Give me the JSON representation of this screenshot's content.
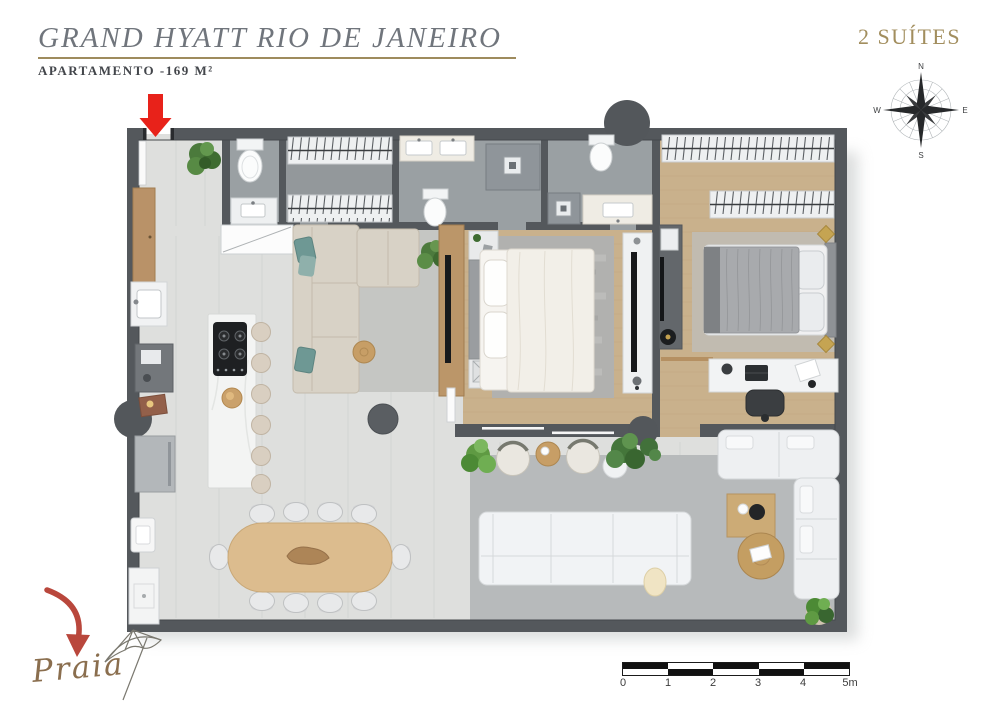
{
  "header": {
    "title": "GRAND HYATT RIO DE JANEIRO",
    "subtitle": "APARTAMENTO -169 M²",
    "suites_label": "2 SUÍTES"
  },
  "compass": {
    "north": "N",
    "east": "E",
    "south": "S",
    "west": "W"
  },
  "scale_bar": {
    "unit_labels": [
      "0",
      "1",
      "2",
      "3",
      "4",
      "5m"
    ]
  },
  "annotations": {
    "beach_label": "Praia"
  },
  "icons": {
    "compass": "compass-rose-icon",
    "entrance": "red-down-arrow-icon",
    "beach_arrow": "red-curved-arrow-icon",
    "umbrella": "beach-umbrella-icon"
  },
  "colors": {
    "accent_gold": "#9e8b5d",
    "title_gray": "#70757c",
    "subtitle_gray": "#43464b",
    "suites_gold": "#a28e5e",
    "wall_gray": "#54585c",
    "entrance_red": "#e8221a",
    "beach_arrow_red": "#b9473c",
    "beach_text_brown": "#8a6e4e",
    "wood_floor": "#c9b18c",
    "tile_floor": "#dedfdd",
    "bath_floor": "#9aa0a3"
  }
}
